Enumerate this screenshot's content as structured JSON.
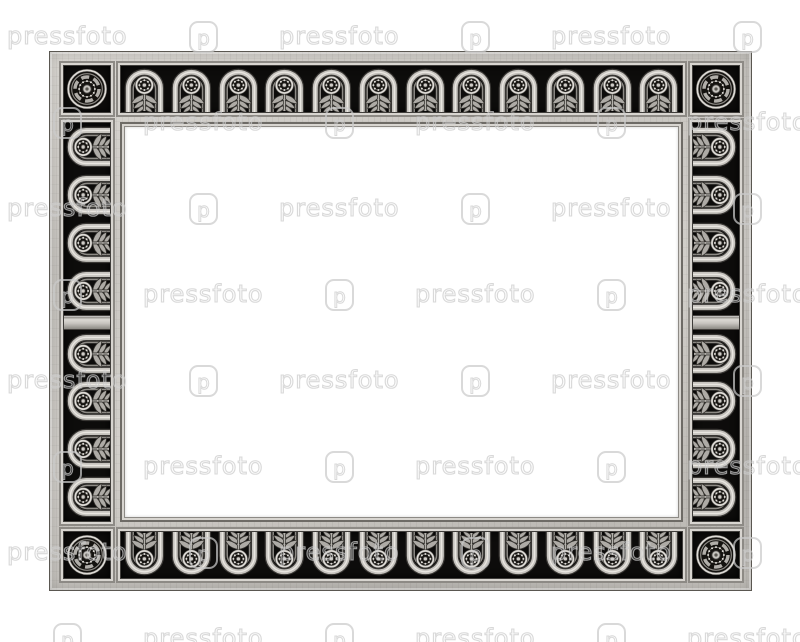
{
  "photo": {
    "background_color": "#ffffff",
    "subject": "empty decorative silver metal picture frame with black inlaid ornament strips"
  },
  "watermark": {
    "text": "pressfoto",
    "logo_glyph": "p",
    "stroke_color": "rgba(203,203,203,0.72)",
    "rows": 8,
    "row_start_y": 24,
    "row_step_y": 86,
    "col_period_x": 272,
    "even_row_x": 7,
    "odd_row_x": 143,
    "logo_dx": 182,
    "tile_k_min": -1,
    "tile_k_max": 3
  },
  "frame": {
    "colors": {
      "metal_highlight": "#e9e6e1",
      "metal_mid": "#c6c3be",
      "metal_dark": "#8d8a85",
      "metal_shadow": "#393734",
      "panel_black": "#0d0c0b"
    },
    "top_units": 12,
    "bottom_units": 12,
    "left_units": 8,
    "right_units": 8,
    "corner_count": 4
  }
}
